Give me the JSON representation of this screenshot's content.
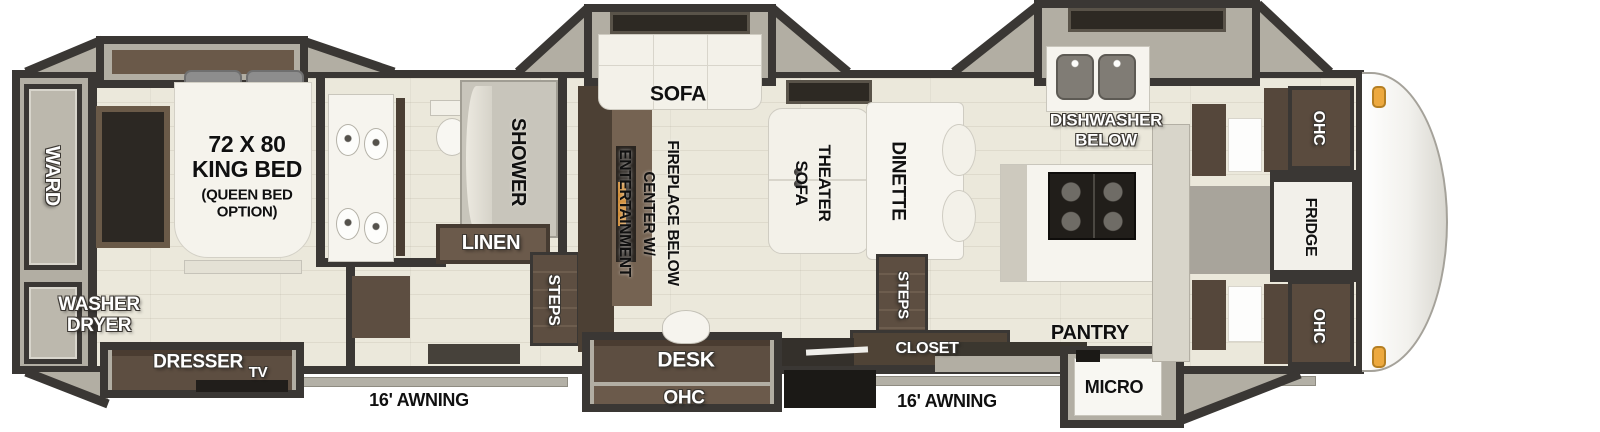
{
  "title": "Fifth Wheel RV Floor Plan",
  "colors": {
    "wall": "#3a3734",
    "floor": "#ebe8db",
    "cabinet_brown": "#5d4e41",
    "slide_gray": "#b2aea3",
    "clearance_light_orange": "#eda93f"
  },
  "bedroom": {
    "ward": "WARD",
    "washer_dryer": "WASHER\nDRYER",
    "bed_size": "72 X 80\nKING BED",
    "bed_option": "(QUEEN BED\nOPTION)",
    "dresser": "DRESSER",
    "tv": "TV"
  },
  "bath": {
    "shower": "SHOWER",
    "linen": "LINEN",
    "steps": "STEPS"
  },
  "living": {
    "sofa": "SOFA",
    "entertainment": "ENTERTAINMENT\nCENTER W/\nFIREPLACE BELOW",
    "theater_sofa": "THEATER\nSOFA",
    "dinette": "DINETTE",
    "steps": "STEPS",
    "closet": "CLOSET",
    "desk": "DESK",
    "desk_ohc": "OHC"
  },
  "kitchen": {
    "dishwasher": "DISHWASHER\nBELOW",
    "pantry": "PANTRY",
    "micro": "MICRO"
  },
  "front": {
    "ohc_top": "OHC",
    "fridge": "FRIDGE",
    "ohc_bottom": "OHC"
  },
  "exterior": {
    "awning_left": "16' AWNING",
    "awning_right": "16' AWNING"
  }
}
